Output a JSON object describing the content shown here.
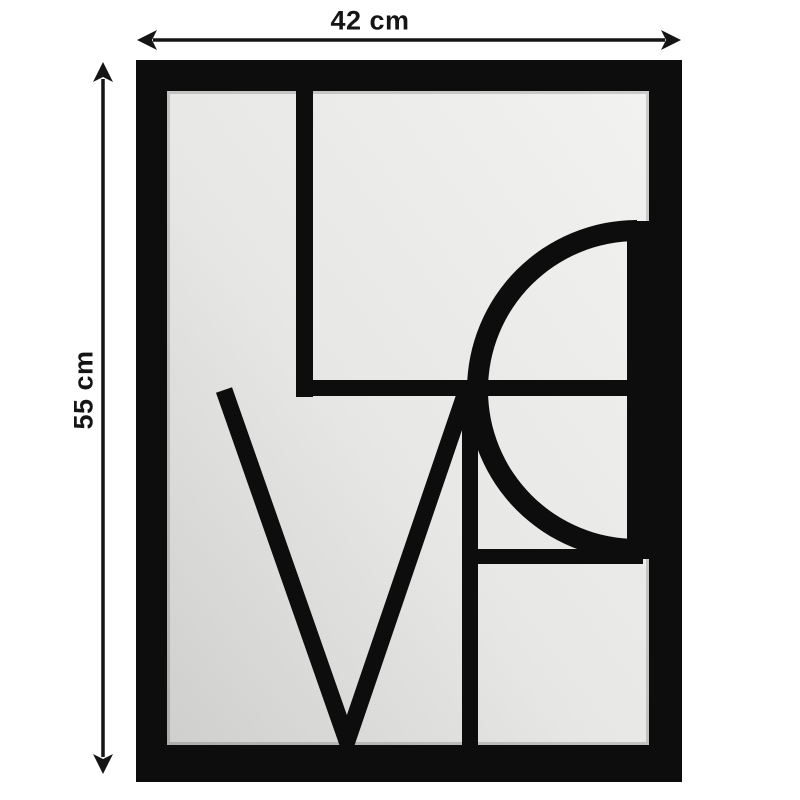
{
  "diagram": {
    "design_word": "LOVE",
    "width_dimension": {
      "label": "42 cm"
    },
    "height_dimension": {
      "label": "55 cm"
    }
  },
  "colors": {
    "background": "#ffffff",
    "frame": "#0d0d0d",
    "mirror_light": "#f2f2f0",
    "mirror_mid": "#e7e7e5",
    "mirror_dark": "#cfcfcd",
    "annotation": "#151515"
  }
}
